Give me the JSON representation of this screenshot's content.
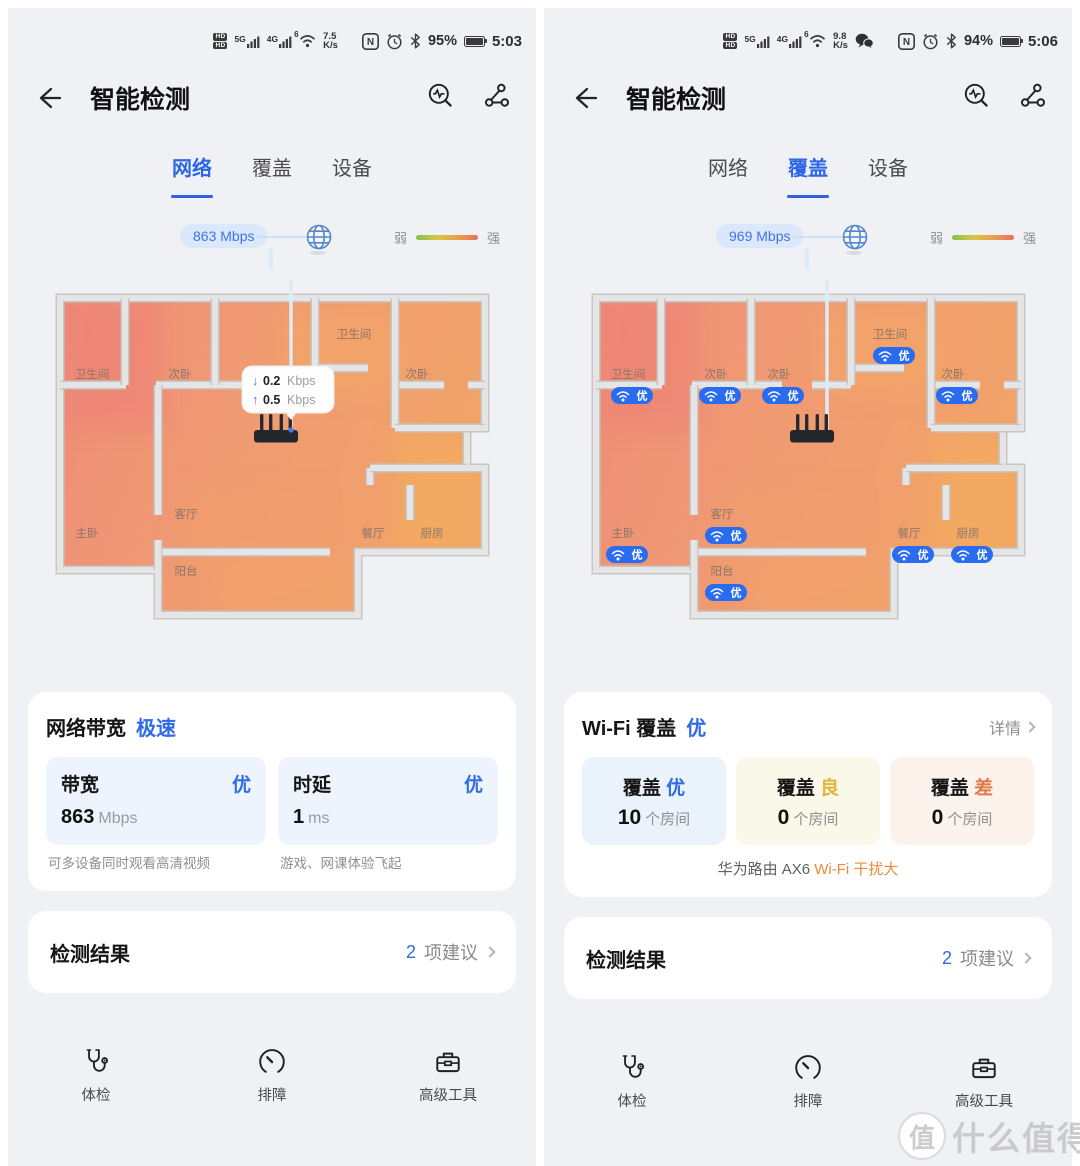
{
  "app": {
    "title": "智能检测"
  },
  "colors": {
    "accent_blue": "#2f6be6",
    "grade_yellow": "#e2b53a",
    "grade_orange": "#e0794a",
    "warn_orange": "#f08a3a",
    "badge_blue": "#2a6cf0",
    "heat_low": "#ee8b7a",
    "heat_high": "#f1a468"
  },
  "floorplan_rooms": [
    {
      "name": "卫生间",
      "x": 62,
      "y": 98
    },
    {
      "name": "次卧",
      "x": 150,
      "y": 98
    },
    {
      "name": "次卧",
      "x": 213,
      "y": 98,
      "center": true
    },
    {
      "name": "卫生间",
      "x": 324,
      "y": 58
    },
    {
      "name": "次卧",
      "x": 387,
      "y": 98
    },
    {
      "name": "主卧",
      "x": 57,
      "y": 257
    },
    {
      "name": "客厅",
      "x": 156,
      "y": 238
    },
    {
      "name": "阳台",
      "x": 156,
      "y": 295
    },
    {
      "name": "餐厅",
      "x": 343,
      "y": 257
    },
    {
      "name": "厨房",
      "x": 402,
      "y": 257
    }
  ],
  "panels": {
    "left": {
      "status": {
        "sim_badges": [
          "HD",
          "HD"
        ],
        "net1": "5G",
        "net2": "4G",
        "wifi_gen": "6",
        "speed": "7.5",
        "speed_unit": "K/s",
        "wechat": false,
        "nfc": "N",
        "battery_pct": "95%",
        "time": "5:03"
      },
      "nav_title": "智能检测",
      "tabs": [
        {
          "label": "网络",
          "active": true
        },
        {
          "label": "覆盖",
          "active": false
        },
        {
          "label": "设备",
          "active": false
        }
      ],
      "uplink_pill": "863 Mbps",
      "legend": {
        "weak": "弱",
        "strong": "强"
      },
      "floorplan": {
        "show_badges": false,
        "hide_center_room": true,
        "tooltip": {
          "down_value": "0.2",
          "up_value": "0.5",
          "unit": "Kbps"
        }
      },
      "summary_card": {
        "title": "网络带宽",
        "grade": "极速",
        "metrics": [
          {
            "label": "带宽",
            "grade": "优",
            "value": "863",
            "unit": "Mbps",
            "caption": "可多设备同时观看高清视频"
          },
          {
            "label": "时延",
            "grade": "优",
            "value": "1",
            "unit": "ms",
            "caption": "游戏、网课体验飞起"
          }
        ]
      },
      "result_row": {
        "label": "检测结果",
        "count": "2",
        "suffix": "项建议"
      },
      "nav": [
        {
          "label": "体检",
          "icon": "stethoscope"
        },
        {
          "label": "排障",
          "icon": "gauge"
        },
        {
          "label": "高级工具",
          "icon": "toolbox"
        }
      ]
    },
    "right": {
      "status": {
        "sim_badges": [
          "HD",
          "HD"
        ],
        "net1": "5G",
        "net2": "4G",
        "wifi_gen": "6",
        "speed": "9.8",
        "speed_unit": "K/s",
        "wechat": true,
        "nfc": "N",
        "battery_pct": "94%",
        "time": "5:06"
      },
      "nav_title": "智能检测",
      "tabs": [
        {
          "label": "网络",
          "active": false
        },
        {
          "label": "覆盖",
          "active": true
        },
        {
          "label": "设备",
          "active": false
        }
      ],
      "uplink_pill": "969 Mbps",
      "legend": {
        "weak": "弱",
        "strong": "强"
      },
      "floorplan": {
        "show_badges": true,
        "hide_center_room": false,
        "wifi_grade": "优"
      },
      "coverage_card": {
        "title": "Wi-Fi 覆盖",
        "grade": "优",
        "detail": "详情",
        "buckets": [
          {
            "label": "覆盖",
            "grade": "优",
            "count": "10",
            "unit": "个房间",
            "tone": "blue"
          },
          {
            "label": "覆盖",
            "grade": "良",
            "count": "0",
            "unit": "个房间",
            "tone": "yellow"
          },
          {
            "label": "覆盖",
            "grade": "差",
            "count": "0",
            "unit": "个房间",
            "tone": "orange"
          }
        ],
        "footer_plain": "华为路由 AX6 ",
        "footer_warn": "Wi-Fi 干扰大"
      },
      "result_row": {
        "label": "检测结果",
        "count": "2",
        "suffix": "项建议"
      },
      "nav": [
        {
          "label": "体检",
          "icon": "stethoscope"
        },
        {
          "label": "排障",
          "icon": "gauge"
        },
        {
          "label": "高级工具",
          "icon": "toolbox"
        }
      ]
    }
  },
  "watermark": {
    "badge": "值",
    "text": "什么值得买"
  }
}
